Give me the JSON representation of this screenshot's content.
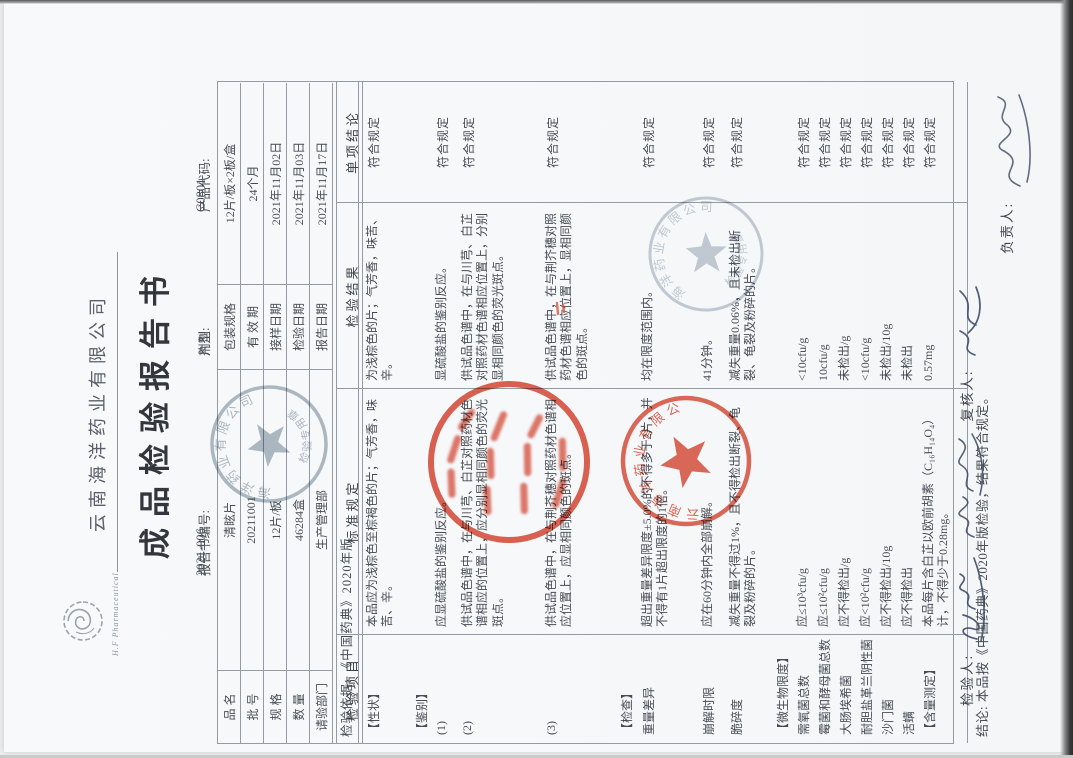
{
  "page": {
    "company": "云南海洋药业有限公司",
    "logo_caption": "H.F Pharmaceutical",
    "title": "成品检验报告书",
    "report_no_label": "报告书编号:",
    "report_no": "2021-006",
    "dosage_form_label": "剂型:",
    "dosage_form": "片剂",
    "product_code_label": "产品代码:",
    "product_code": "C0801"
  },
  "info_table": {
    "rows": [
      {
        "l1": "品  名",
        "v1": "清眩片",
        "l2": "包装规格",
        "v2": "12片/板×2板/盒"
      },
      {
        "l1": "批  号",
        "v1": "20211001",
        "l2": "有 效 期",
        "v2": "24个月"
      },
      {
        "l1": "规  格",
        "v1": "12片/板",
        "l2": "接样日期",
        "v2": "2021年11月02日"
      },
      {
        "l1": "数  量",
        "v1": "46284盒",
        "l2": "检验日期",
        "v2": "2021年11月03日"
      },
      {
        "l1": "请验部门",
        "v1": "生产管理部",
        "l2": "报告日期",
        "v2": "2021年11月17日"
      }
    ],
    "basis": "检验依据: 《中国药典》2020年版"
  },
  "main_table": {
    "headers": [
      "检验项目",
      "标准规定",
      "检验结果",
      "单项结论"
    ],
    "rows": [
      {
        "item": "【性状】",
        "standard": "本品应为浅棕色至棕褐色的片；气芳香，味苦、辛。",
        "result": "为浅棕色的片；气芳香，味苦、辛。",
        "conclusion": "符合规定"
      },
      {
        "item": "【鉴别】",
        "standard": "",
        "result": "",
        "conclusion": ""
      },
      {
        "item": "(1)",
        "standard": "应显硫酸盐的鉴别反应。",
        "result": "显硫酸盐的鉴别反应。",
        "conclusion": "符合规定"
      },
      {
        "item": "(2)",
        "standard": "供试品色谱中，在与川芎、白芷对照药材色谱相应的位置上，应分别显相同颜色的荧光斑点。",
        "result": "供试品色谱中，在与川芎、白芷对照药材色谱相应位置上，分别显相同颜色的荧光斑点。",
        "conclusion": "符合规定"
      },
      {
        "item": "(3)",
        "standard": "供试品色谱中，在与荆芥穗对照药材色谱相应位置上，应显相同颜色的斑点。",
        "result": "供试品色谱中，在与荆芥穗对照药材色谱相应位置上，显相同颜色的斑点。",
        "conclusion": "符合规定"
      },
      {
        "item": "【检查】",
        "standard": "",
        "result": "",
        "conclusion": ""
      },
      {
        "item": "重量差异",
        "standard": "超出重量差异限度±5.0%的不得多于2片，并不得有1片超出限度的1倍。",
        "result": "均在限度范围内。",
        "conclusion": "符合规定"
      },
      {
        "item": "崩解时限",
        "standard": "应在60分钟内全部崩解。",
        "result": "41分钟。",
        "conclusion": "符合规定"
      },
      {
        "item": "脆碎度",
        "standard": "减失重量不得过1%，且不得检出断裂、龟裂及粉碎的片。",
        "result": "减失重量0.06%，且未检出断裂、龟裂及粉碎的片。",
        "conclusion": "符合规定"
      },
      {
        "item": "【微生物限度】",
        "standard": "",
        "result": "",
        "conclusion": ""
      },
      {
        "item": "需氧菌总数",
        "standard": "应≤10³cfu/g",
        "result": "<10cfu/g",
        "conclusion": "符合规定"
      },
      {
        "item": "霉菌和酵母菌总数",
        "standard": "应≤10²cfu/g",
        "result": "10cfu/g",
        "conclusion": "符合规定"
      },
      {
        "item": "大肠埃希菌",
        "standard": "应不得检出/g",
        "result": "未检出/g",
        "conclusion": "符合规定"
      },
      {
        "item": "耐胆盐革兰阴性菌",
        "standard": "应<10²cfu/g",
        "result": "<10cfu/g",
        "conclusion": "符合规定"
      },
      {
        "item": "沙门菌",
        "standard": "应不得检出/10g",
        "result": "未检出/10g",
        "conclusion": "符合规定"
      },
      {
        "item": "活螨",
        "standard": "应不得检出",
        "result": "未检出",
        "conclusion": "符合规定"
      },
      {
        "item": "【含量测定】",
        "standard": "本品每片含白芷以欧前胡素（C₁₆H₁₄O₄）计，不得少于0.28mg。",
        "result": "0.57mg",
        "conclusion": "符合规定"
      }
    ],
    "conclusion_row": "结论: 本品按《中国药典》2020年版检验，结果符合规定。"
  },
  "footer": {
    "inspector_label": "检验人:",
    "reviewer_label": "复核人:",
    "responsible_label": "负责人:"
  },
  "stamps": {
    "gray_arc_top": "海洋药业有限公司",
    "gray_arc_bottom": "检验专用章",
    "red_company_arc": "云南海洋药业有限公司"
  },
  "colors": {
    "stamp_red": "#d9412b",
    "stamp_gray": "#93a2ae",
    "ink": "#3f4e66",
    "paper": "#f8f9fb",
    "table_line": "#959ba4"
  }
}
